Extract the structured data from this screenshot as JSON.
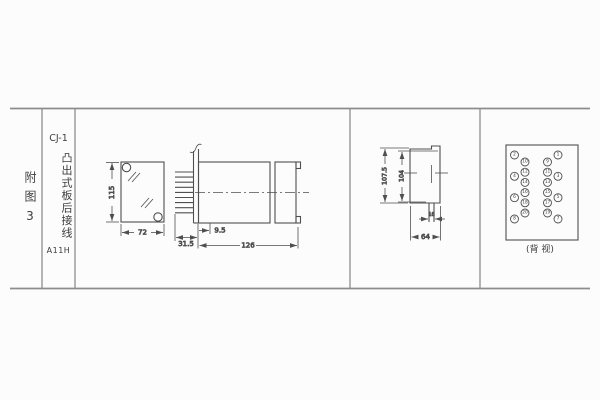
{
  "title_block": {
    "figure_label": "附图3",
    "model": "CJ-1",
    "description": "凸出式板后接线",
    "code": "A11H"
  },
  "front_view": {
    "dim_height": "115",
    "dim_width": "72"
  },
  "side_view": {
    "dim_panel_offset": "9.5",
    "dim_terminal_depth": "31.5",
    "dim_length": "126"
  },
  "rear_view": {
    "dim_outer_height": "107.5",
    "dim_inner_height": "104",
    "dim_stud_spacing": "16",
    "dim_width": "64"
  },
  "back_view": {
    "caption": "(背 视)",
    "terminals": {
      "left_outer": [
        "2",
        "4",
        "6",
        "8"
      ],
      "left_inner": [
        "10",
        "12",
        "14",
        "16",
        "18",
        "20"
      ],
      "right_inner": [
        "9",
        "11",
        "13",
        "15",
        "17",
        "19"
      ],
      "right_outer": [
        "1",
        "3",
        "5",
        "7"
      ]
    }
  }
}
